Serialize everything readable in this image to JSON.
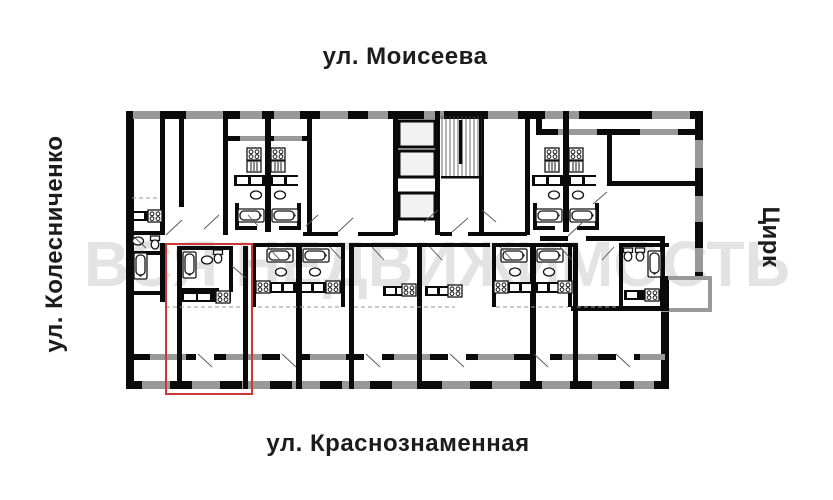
{
  "labels": {
    "street_top": "ул. Моисеева",
    "street_left": "ул. Колесниченко",
    "street_right": "Цирк",
    "street_bottom": "ул. Краснознаменная"
  },
  "watermark": {
    "text": "ВСЯ НЕДВИЖИМОСТЬ",
    "color": "#e3e3e3"
  },
  "highlight": {
    "color": "#cc3636",
    "description": "red outline marking the selected studio apartment (bottom-left of plan)"
  },
  "plan": {
    "type": "residential building floor plan",
    "wall_color": "#0a0a0a",
    "window_color": "#999999",
    "features": [
      "stairwell",
      "elevator shafts",
      "bathtubs",
      "stoves",
      "sinks",
      "toilets",
      "balconies"
    ]
  },
  "colors": {
    "wall": "#0a0a0a",
    "window": "#999999",
    "highlight": "#cc3636",
    "watermark": "#e3e3e3",
    "text": "#1c1c1c"
  }
}
